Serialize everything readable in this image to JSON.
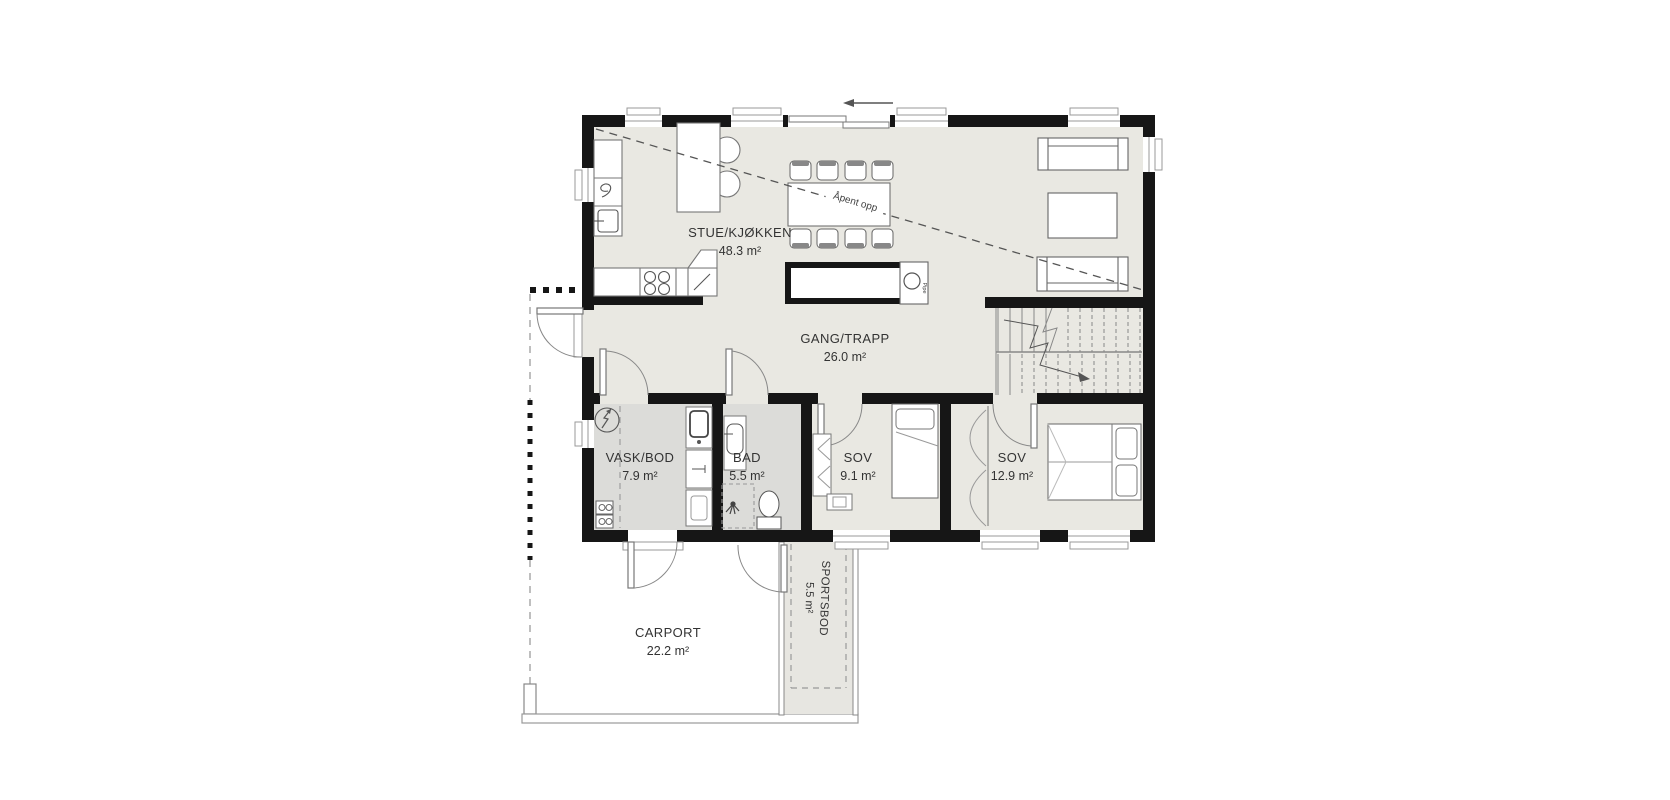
{
  "plan": {
    "title": "First floor plan",
    "colors": {
      "wall": "#161616",
      "floor_main": "#e9e8e2",
      "floor_wet": "#dcdcd9",
      "floor_outbuilding": "#e7e6e1",
      "furniture_line": "#666666",
      "thin_line": "#999999"
    },
    "rooms": [
      {
        "id": "stue-kjokken",
        "name": "STUE/KJØKKEN",
        "area": "48.3 m²"
      },
      {
        "id": "gang-trapp",
        "name": "GANG/TRAPP",
        "area": "26.0 m²"
      },
      {
        "id": "vask-bod",
        "name": "VASK/BOD",
        "area": "7.9 m²"
      },
      {
        "id": "bad",
        "name": "BAD",
        "area": "5.5 m²"
      },
      {
        "id": "sov-1",
        "name": "SOV",
        "area": "9.1 m²"
      },
      {
        "id": "sov-2",
        "name": "SOV",
        "area": "12.9 m²"
      },
      {
        "id": "carport",
        "name": "CARPORT",
        "area": "22.2 m²"
      },
      {
        "id": "sportsbod",
        "name": "SPORTSBOD",
        "area": "5.5 m²"
      }
    ],
    "annotations": {
      "open_above": "Åpent opp",
      "chimney": "Pipe"
    }
  }
}
